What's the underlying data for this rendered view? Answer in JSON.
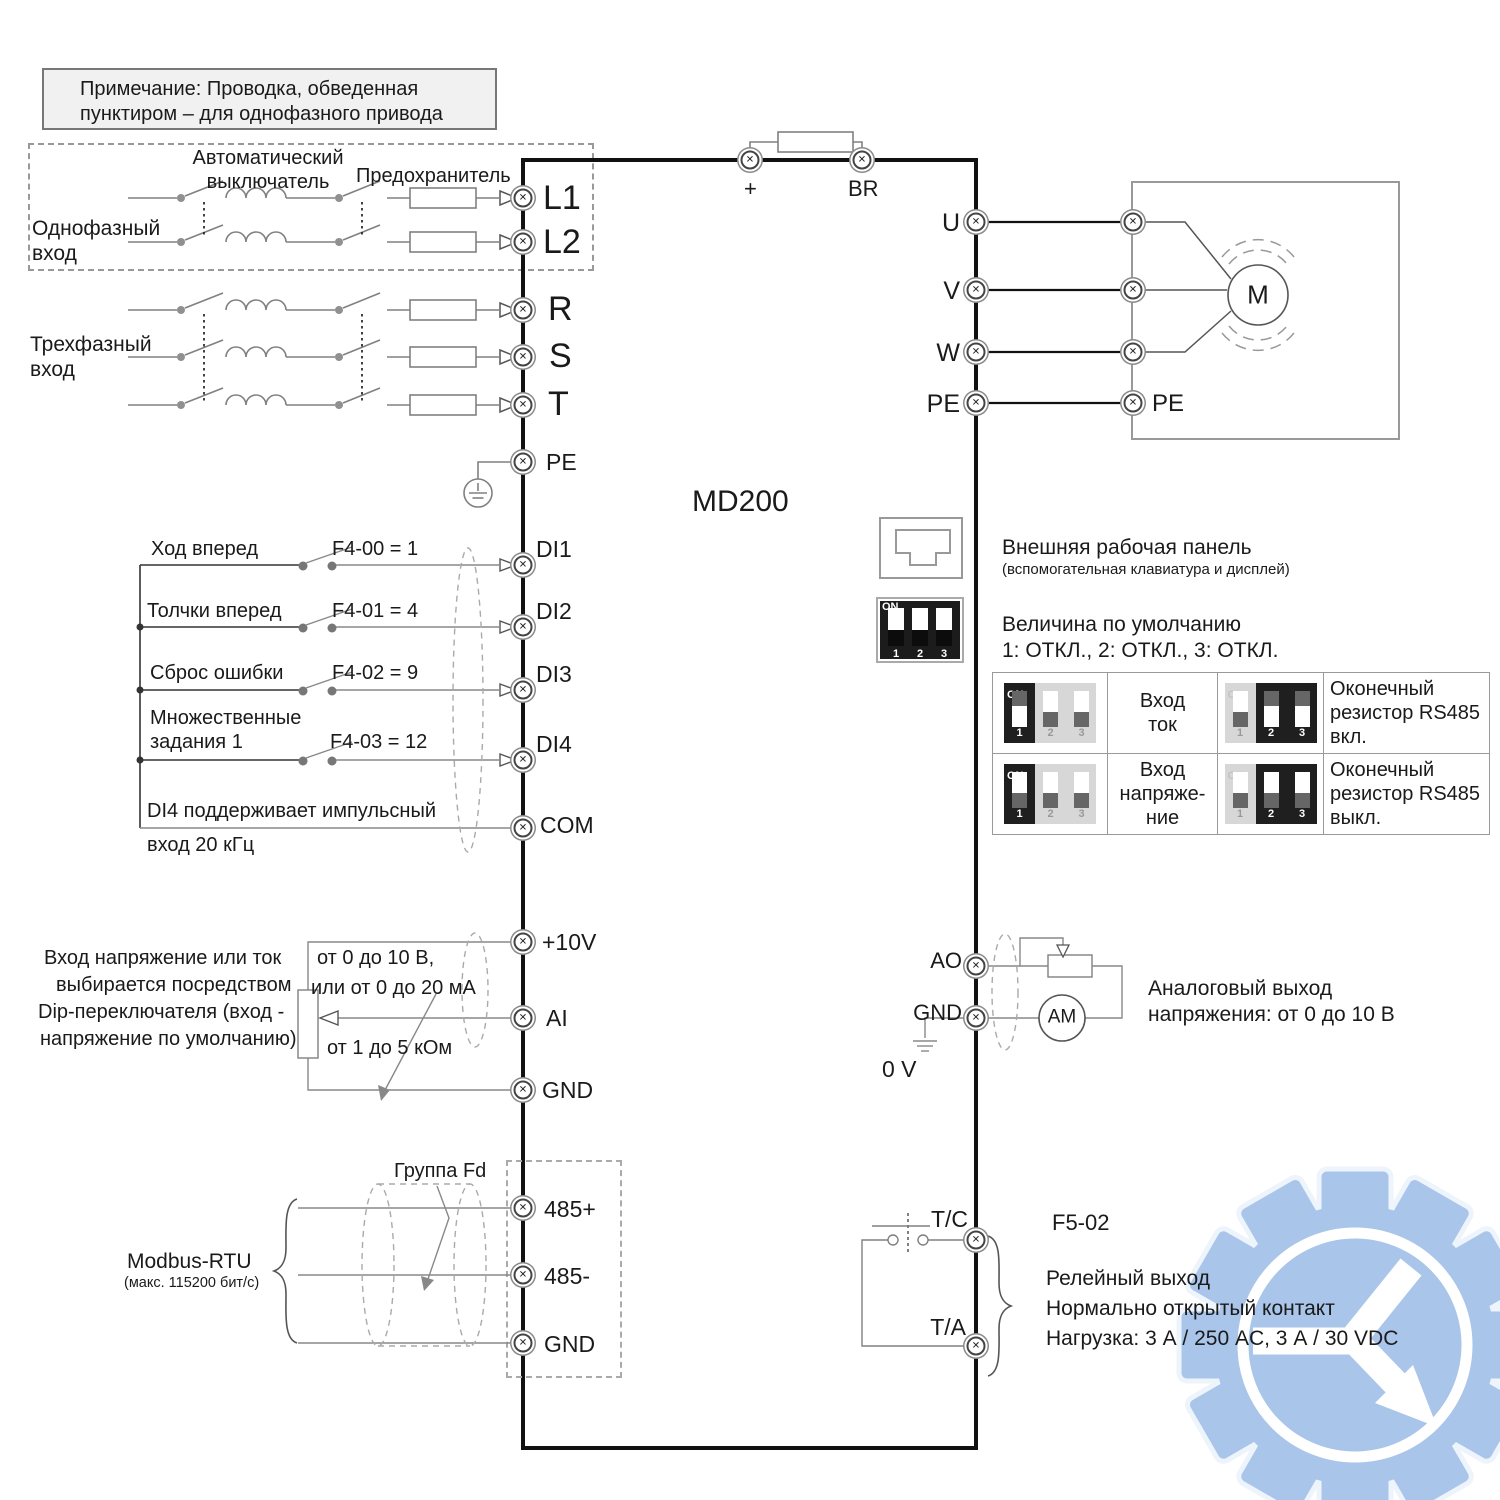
{
  "note": {
    "line1": "Примечание: Проводка, обведенная",
    "line2": "пунктиром – для однофазного привода"
  },
  "model": "MD200",
  "input": {
    "breaker_line1": "Автоматический",
    "breaker_line2": "выключатель",
    "fuse": "Предохранитель",
    "single_phase_line1": "Однофазный",
    "single_phase_line2": "вход",
    "three_phase_line1": "Трехфазный",
    "three_phase_line2": "вход",
    "l1": "L1",
    "l2": "L2",
    "r": "R",
    "s": "S",
    "t": "T",
    "pe": "PE"
  },
  "dc": {
    "plus": "+",
    "br": "BR"
  },
  "output": {
    "u": "U",
    "v": "V",
    "w": "W",
    "pe": "PE",
    "motor_pe": "PE",
    "motor": "M"
  },
  "di": {
    "row1_label": "Ход вперед",
    "row1_param": "F4-00 = 1",
    "row1_term": "DI1",
    "row2_label": "Толчки вперед",
    "row2_param": "F4-01 = 4",
    "row2_term": "DI2",
    "row3_label": "Сброс ошибки",
    "row3_param": "F4-02 = 9",
    "row3_term": "DI3",
    "row4_label_line1": "Множественные",
    "row4_label_line2": "задания 1",
    "row4_param": "F4-03 = 12",
    "row4_term": "DI4",
    "note_line1": "DI4 поддерживает импульсный",
    "note_line2": "вход 20 кГц",
    "com": "COM"
  },
  "analog_in": {
    "desc_line1": "Вход напряжение или ток",
    "desc_line2": "выбирается посредством",
    "desc_line3": "Dip-переключателя (вход -",
    "desc_line4": "напряжение по умолчанию)",
    "range_line1": "от 0 до 10 В,",
    "range_line2": "или от 0 до 20 мА",
    "resistance": "от 1 до 5 кОм",
    "p10": "+10V",
    "ai": "AI",
    "gnd": "GND"
  },
  "rs485": {
    "group": "Группа Fd",
    "name": "Modbus-RTU",
    "speed": "(макс. 115200 бит/с)",
    "p": "485+",
    "n": "485-",
    "gnd": "GND"
  },
  "panel": {
    "title": "Внешняя рабочая панель",
    "subtitle": "(вспомогательная клавиатура и дисплей)"
  },
  "dip": {
    "on": "ON",
    "n1": "1",
    "n2": "2",
    "n3": "3",
    "default_title": "Величина по умолчанию",
    "default_values": "1: ОТКЛ., 2: ОТКЛ., 3: ОТКЛ."
  },
  "dip_table": {
    "r1_mode_line1": "Вход",
    "r1_mode_line2": "ток",
    "r1_rs_line1": "Оконечный",
    "r1_rs_line2": "резистор RS485",
    "r1_rs_line3": "вкл.",
    "r2_mode_line1": "Вход",
    "r2_mode_line2": "напряже-",
    "r2_mode_line3": "ние",
    "r2_rs_line1": "Оконечный",
    "r2_rs_line2": "резистор RS485",
    "r2_rs_line3": "выкл."
  },
  "analog_out": {
    "ao": "AO",
    "gnd": "GND",
    "zero": "0 V",
    "meter": "AM",
    "desc_line1": "Аналоговый выход",
    "desc_line2": "напряжения: от 0 до 10 В"
  },
  "relay": {
    "param": "F5-02",
    "tc": "T/C",
    "ta": "T/A",
    "desc_line1": "Релейный выход",
    "desc_line2": "Нормально открытый контакт",
    "desc_line3": "Нагрузка: 3 А / 250 AC, 3 А / 30 VDC"
  }
}
